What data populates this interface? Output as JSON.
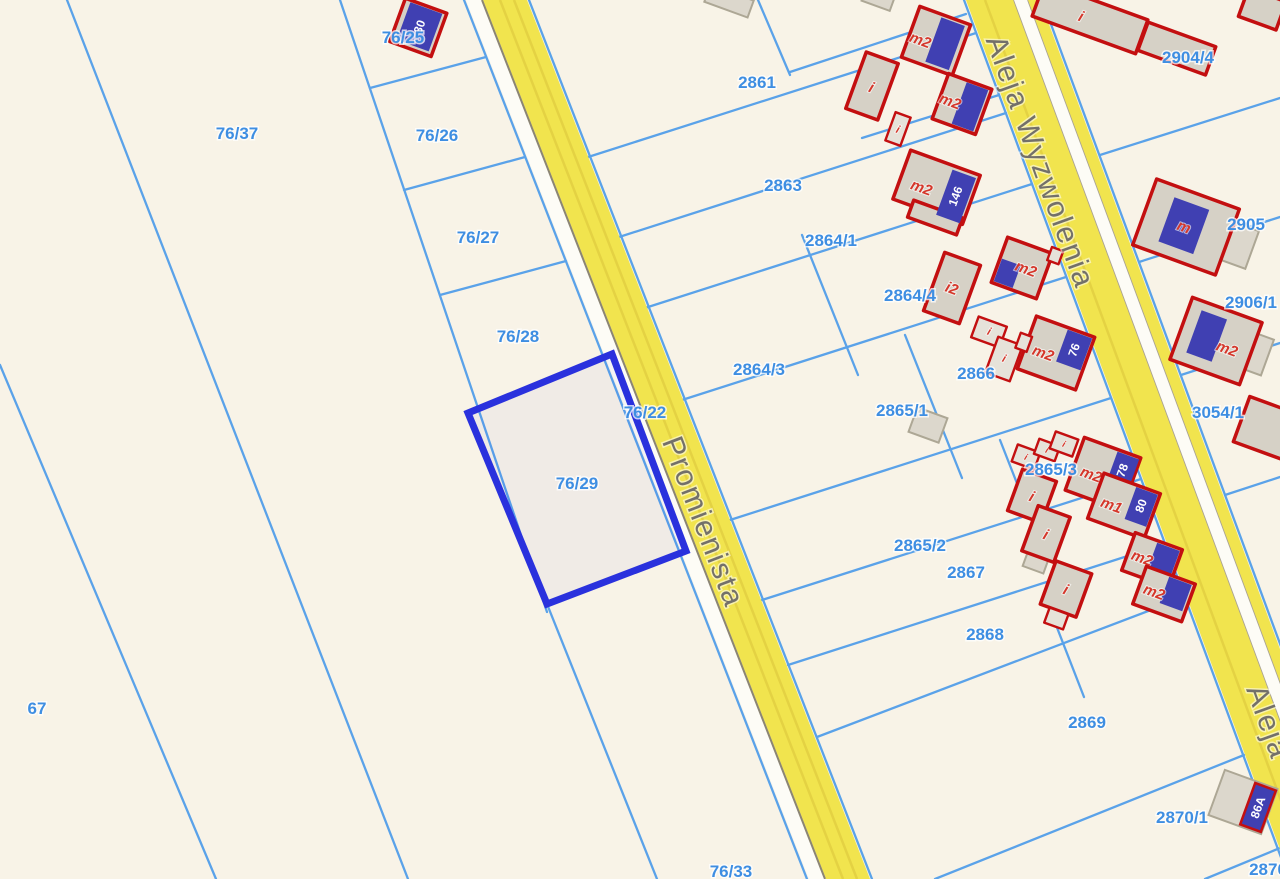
{
  "app": {
    "type": "cadastral-parcel-map-viewer"
  },
  "colors": {
    "background": "#f8f3e7",
    "parcel_line": "#5aa2e9",
    "parcel_label": "#3e8ee2",
    "selection": "#2a31dd",
    "road_fill": "#f1e44e",
    "road_edge": "#8b8574",
    "street_label": "#73706a",
    "building_border": "#c30f10",
    "building_fill": "#d6d1c6",
    "building_label": "#d5372b",
    "address_plate": "#4040b2",
    "address_text": "#ffffff"
  },
  "selection": {
    "parcel": "76/29"
  },
  "streets": [
    {
      "name": "Promienista"
    },
    {
      "name": "Aleja Wyzwolenia"
    },
    {
      "name": "Aleja"
    }
  ],
  "parcels": [
    {
      "label": "76/37"
    },
    {
      "label": "76/25"
    },
    {
      "label": "76/26"
    },
    {
      "label": "76/27"
    },
    {
      "label": "76/28"
    },
    {
      "label": "76/29"
    },
    {
      "label": "76/22"
    },
    {
      "label": "76/33"
    },
    {
      "label": "67"
    },
    {
      "label": "2861"
    },
    {
      "label": "2863"
    },
    {
      "label": "2864/1"
    },
    {
      "label": "2864/4"
    },
    {
      "label": "2864/3"
    },
    {
      "label": "2865/1"
    },
    {
      "label": "2866"
    },
    {
      "label": "2865/3"
    },
    {
      "label": "2865/2"
    },
    {
      "label": "2867"
    },
    {
      "label": "2868"
    },
    {
      "label": "2869"
    },
    {
      "label": "2870/1"
    },
    {
      "label": "2870"
    },
    {
      "label": "2904/4"
    },
    {
      "label": "2905"
    },
    {
      "label": "2906/1"
    },
    {
      "label": "3054/1"
    }
  ],
  "buildings": [
    {
      "address": "30"
    },
    {
      "label": "m2"
    },
    {
      "label": "i"
    },
    {
      "label": "i"
    },
    {
      "label": "m2"
    },
    {
      "label": "m2",
      "address": "146"
    },
    {
      "label": "m2"
    },
    {
      "label": "i2"
    },
    {
      "label": "i"
    },
    {
      "label": "i"
    },
    {
      "label": "m2",
      "address": "76"
    },
    {
      "label": "i"
    },
    {
      "label": "i"
    },
    {
      "label": "i"
    },
    {
      "label": "i"
    },
    {
      "label": "i"
    },
    {
      "label": "m2",
      "address": "78"
    },
    {
      "label": "m1",
      "address": "80"
    },
    {
      "label": "m2"
    },
    {
      "label": "m2"
    },
    {
      "label": "i"
    },
    {
      "label": "i"
    },
    {
      "label": "m"
    },
    {
      "label": "m2"
    },
    {
      "address": "86A"
    }
  ]
}
